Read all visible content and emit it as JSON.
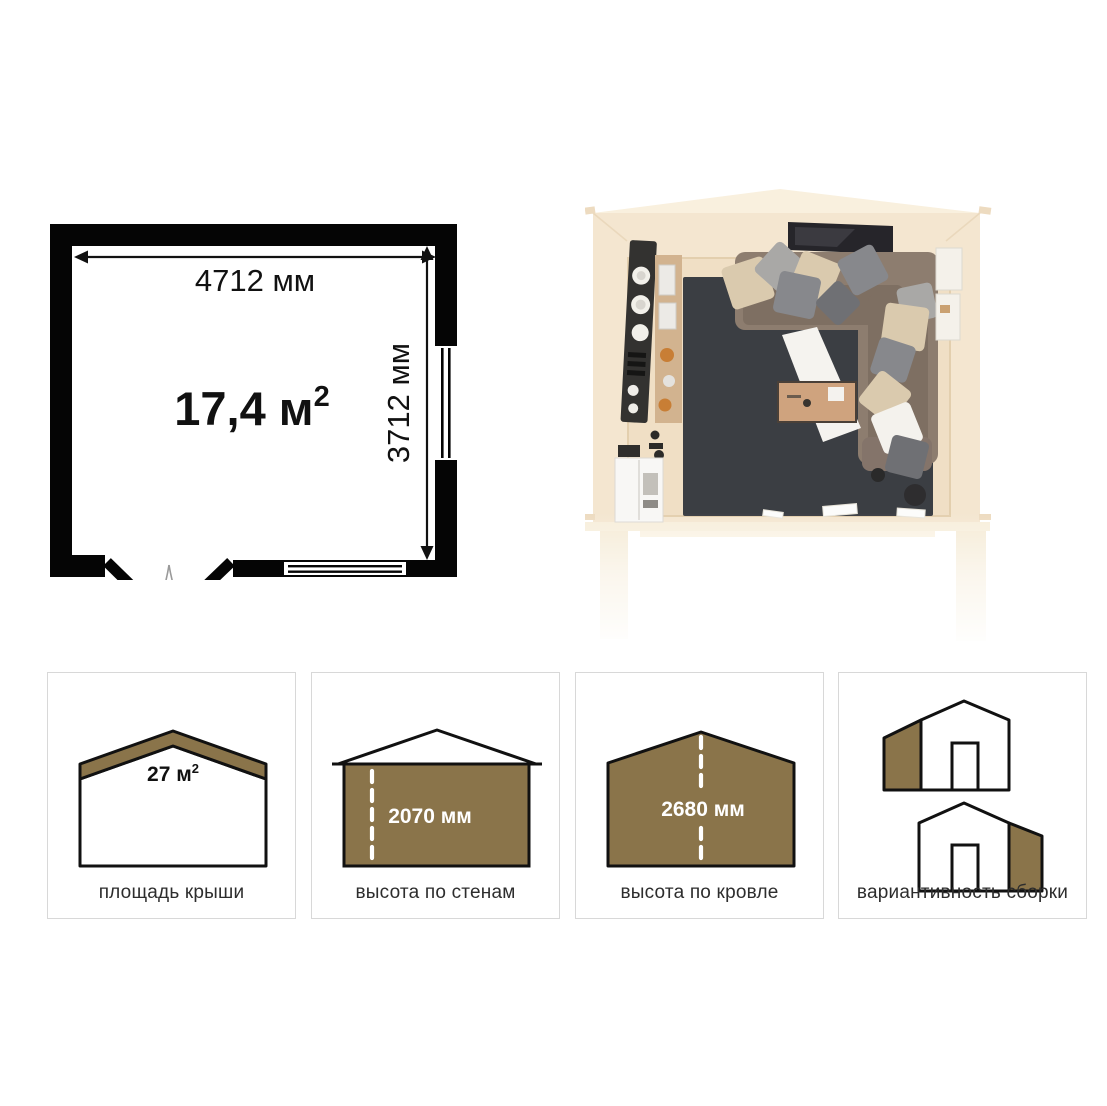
{
  "colors": {
    "accent_brown": "#8A744A",
    "wall_black": "#050505",
    "card_border": "#d8d8d8",
    "label_text": "#2d2d2d",
    "dash_white": "#ffffff",
    "rug_dark": "#3b3e43",
    "wood_cream": "#f4e6d0"
  },
  "floor_plan": {
    "width_label": "4712 мм",
    "depth_label": "3712 мм",
    "area_value": "17,4 м",
    "area_sup": "2"
  },
  "cards": [
    {
      "label": "площадь крыши",
      "value": "27 м",
      "value_sup": "2"
    },
    {
      "label": "высота по стенам",
      "value": "2070 мм"
    },
    {
      "label": "высота по кровле",
      "value": "2680 мм"
    },
    {
      "label": "вариантивность сборки"
    }
  ]
}
